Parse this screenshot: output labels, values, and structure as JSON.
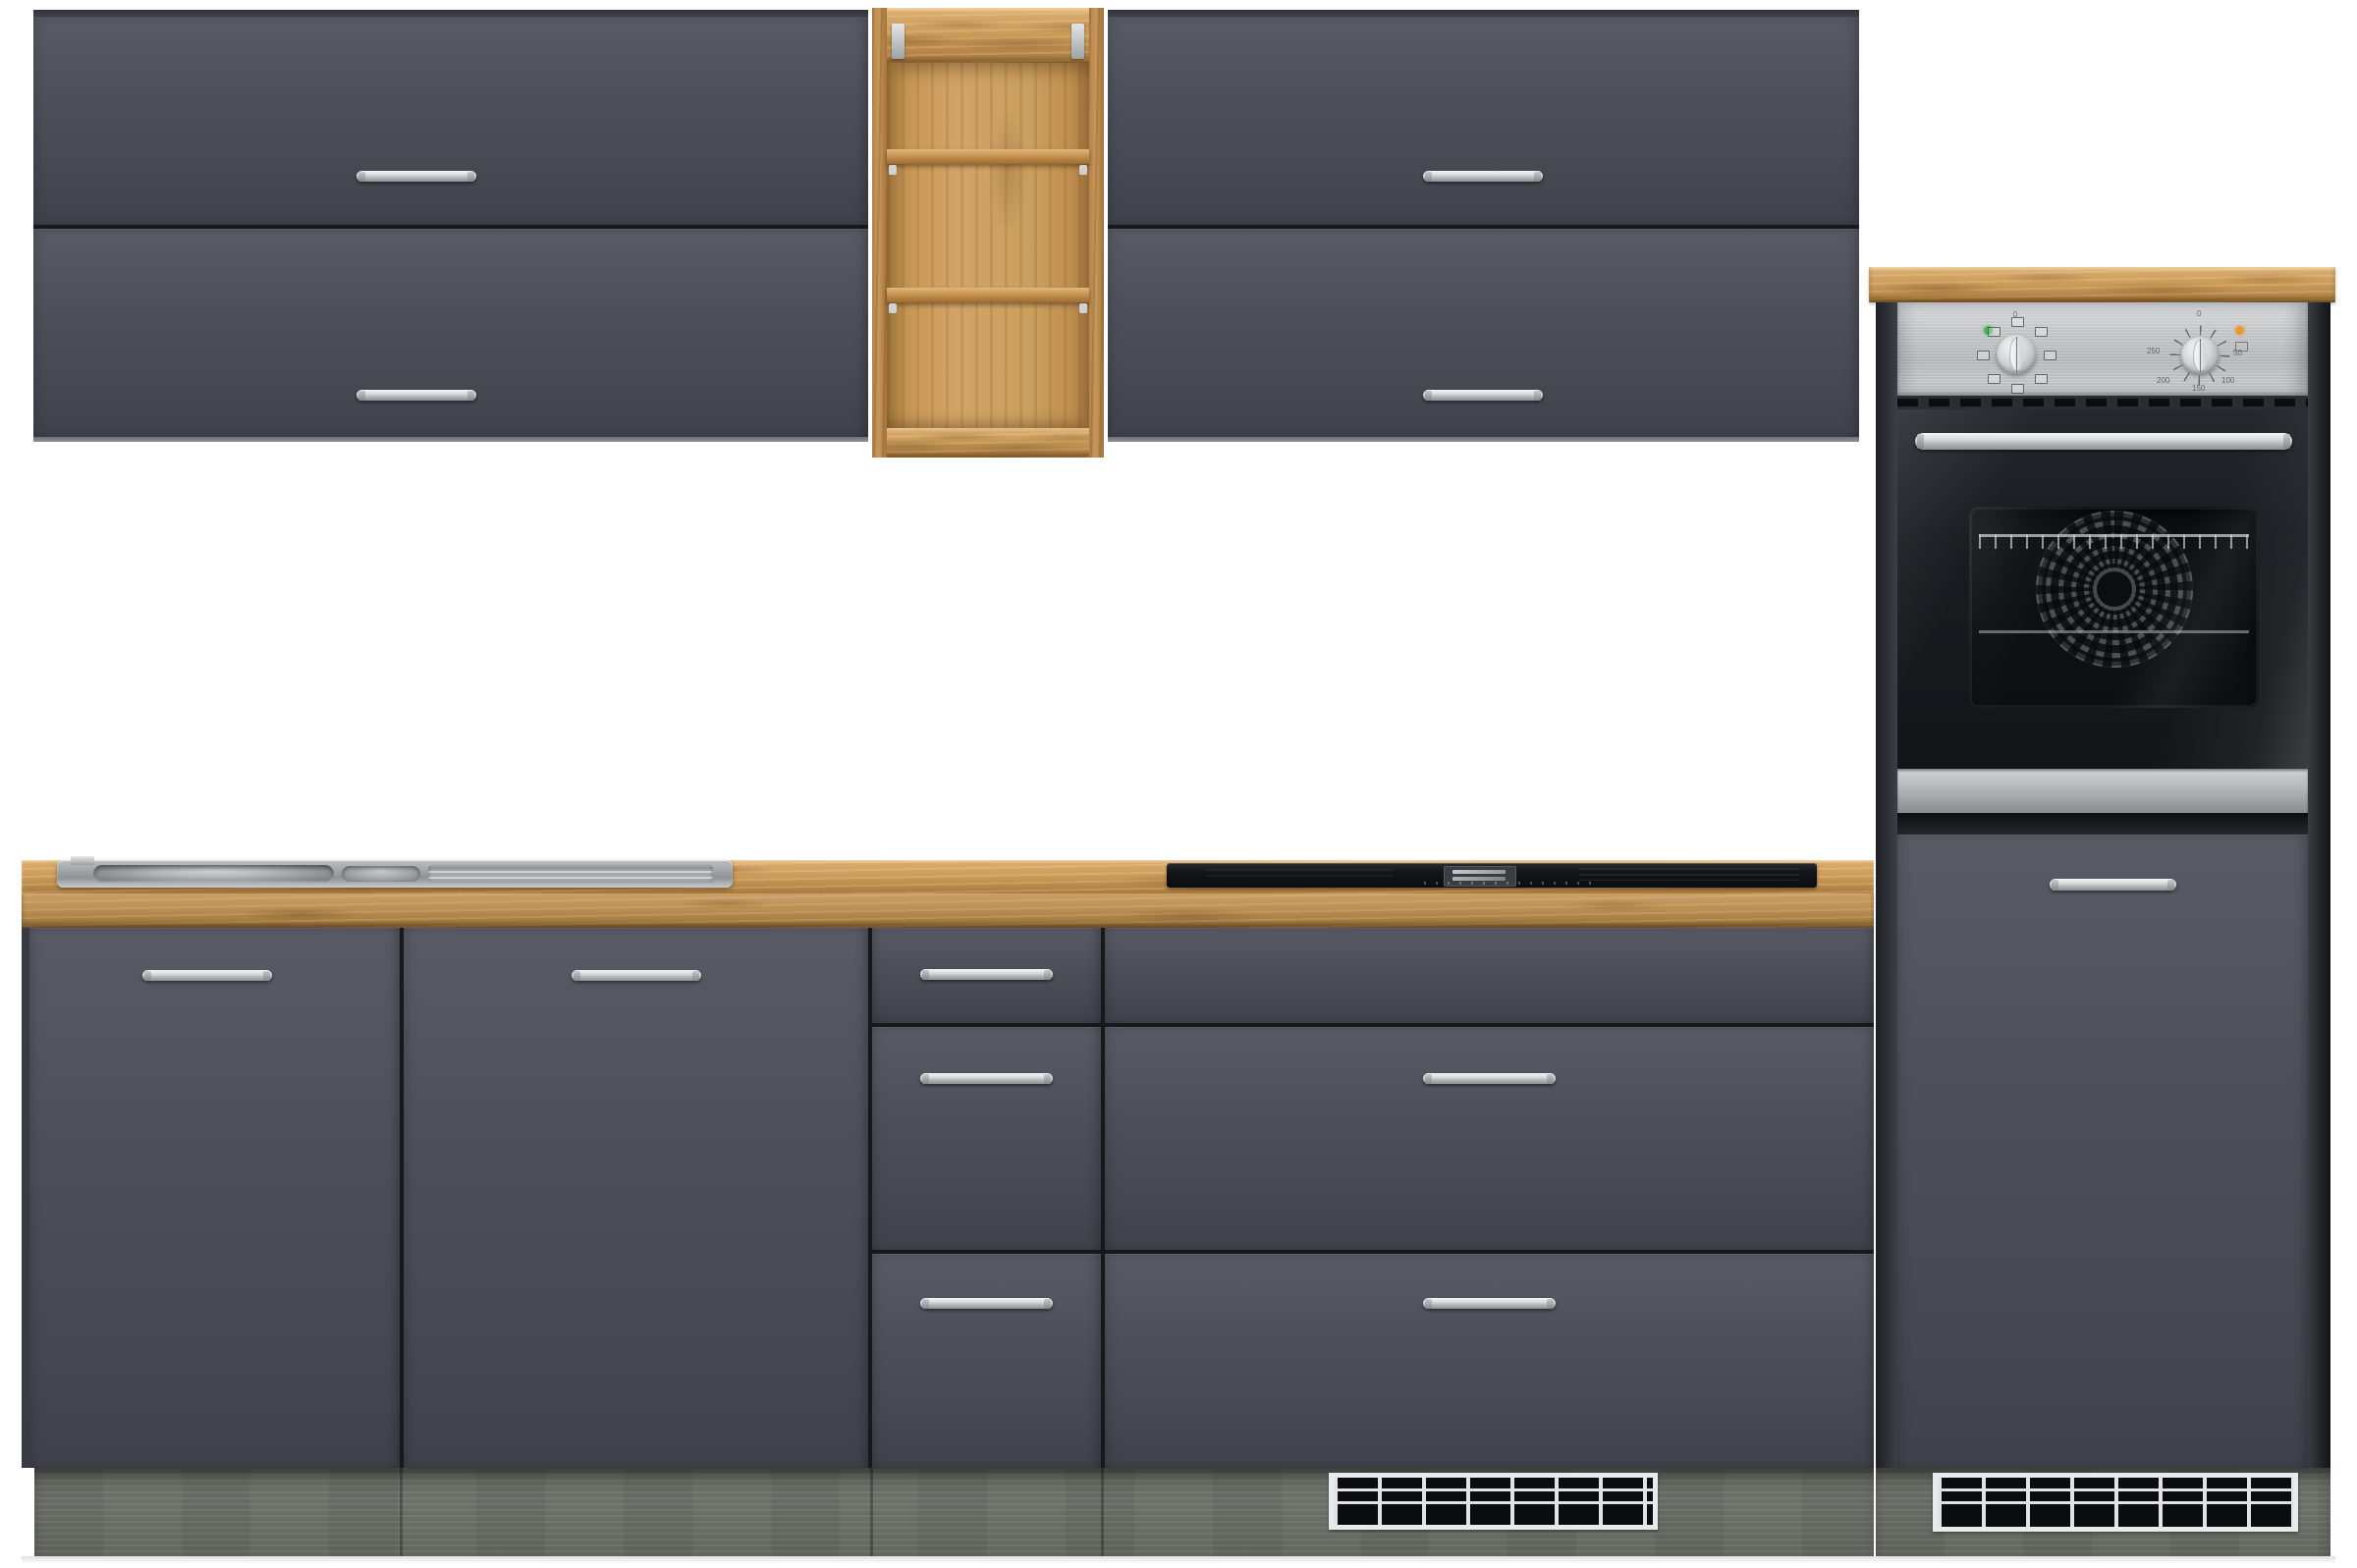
{
  "meta": {
    "scene": "product-photo-kitchen-cabinet-set",
    "description": "Modern grey kitchen unit set with oak worktop, open oak shelf, built-in stainless oven, induction cooktop, inset sink and ventilation grilles"
  },
  "palette": {
    "background": "#ffffff",
    "front_grey": "#4d505a",
    "front_grey_light": "#585b65",
    "front_grey_dark": "#3f424a",
    "carcass_dark": "#33363c",
    "gap_dark": "#16181c",
    "edge_light": "#8a8e96",
    "oak_light": "#dcae72",
    "oak_mid": "#c99a58",
    "oak_dark": "#a97a3e",
    "shelf_back": "#d0a266",
    "plinth_grey": "#686b64",
    "steel_light": "#d8dadb",
    "steel_mid": "#b2b6b8",
    "steel_dark": "#8e9194",
    "chrome_hi": "#f4f5f6",
    "glass_black": "#131418",
    "indicator_green": "#43b05c",
    "indicator_orange": "#e59a3a",
    "grille_frame": "#e8eaec",
    "slot_black": "#0b0c0e"
  },
  "oven": {
    "function_zero_label": "0",
    "temp_labels": [
      "0",
      "50",
      "100",
      "150",
      "200",
      "250"
    ]
  },
  "components": {
    "wall_cabinet_left": {
      "flap_doors": 2,
      "handles": 2
    },
    "open_shelf": {
      "compartments": 3,
      "shelves": 2,
      "brackets": 2
    },
    "wall_cabinet_right": {
      "flap_doors": 2,
      "handles": 2
    },
    "tall_oven_unit": {
      "knobs": 2,
      "indicator_lights": 2,
      "oven_door_handle": 1,
      "lower_door_handle": 1,
      "vent_grille": 1
    },
    "base_row": {
      "doors": 2,
      "drawer_unit_drawers": 3,
      "cooktop_unit_drawers": 3,
      "vent_grille": 1
    },
    "sink": {
      "bowls": 2,
      "drainer": 1
    },
    "grille_grid": {
      "rows": 3,
      "columns": 7
    }
  }
}
